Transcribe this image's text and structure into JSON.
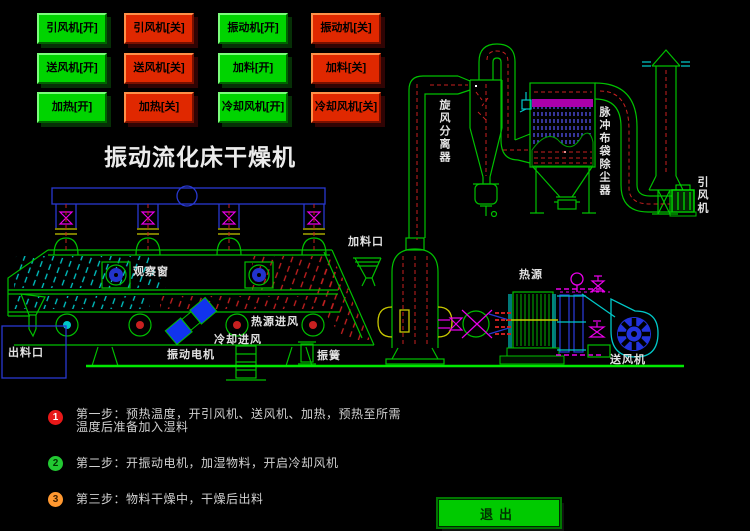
{
  "title": "振动流化床干燥机",
  "buttons": {
    "items": [
      {
        "label": "引风机[开]",
        "state": "on"
      },
      {
        "label": "引风机[关]",
        "state": "off"
      },
      {
        "label": "振动机[开]",
        "state": "on"
      },
      {
        "label": "振动机[关]",
        "state": "off"
      },
      {
        "label": "送风机[开]",
        "state": "on"
      },
      {
        "label": "送风机[关]",
        "state": "off"
      },
      {
        "label": "加料[开]",
        "state": "on"
      },
      {
        "label": "加料[关]",
        "state": "off"
      },
      {
        "label": "加热[开]",
        "state": "on"
      },
      {
        "label": "加热[关]",
        "state": "off"
      },
      {
        "label": "冷却风机[开]",
        "state": "on"
      },
      {
        "label": "冷却风机[关]",
        "state": "off"
      }
    ]
  },
  "diagram": {
    "labels": {
      "cyclone": "旋风分离器",
      "bag_filter": "脉冲布袋除尘器",
      "induced_fan": "引风机",
      "feed_inlet": "加料口",
      "observation_window": "观察窗",
      "heat_air_inlet": "热源进风",
      "cooling_air_inlet": "冷却进风",
      "discharge_outlet": "出料口",
      "vibration_motor": "振动电机",
      "vibration_spring": "振簧",
      "heat_source": "热源",
      "supply_fan": "送风机"
    }
  },
  "steps": {
    "items": [
      {
        "num": "1",
        "line1": "第一步：预热温度，开引风机、送风机、加热，预热至所需",
        "line2": "温度后准备加入湿料"
      },
      {
        "num": "2",
        "line1": "第二步：开振动电机，加湿物料，开启冷却风机",
        "line2": ""
      },
      {
        "num": "3",
        "line1": "第三步：物料干燥中，干燥后出料",
        "line2": ""
      }
    ]
  },
  "exit": {
    "label": "退出"
  },
  "colors": {
    "background": "#000000",
    "button_on": "#00D400",
    "button_off": "#E02800",
    "diagram_green": "#00C000",
    "bright_green": "#00E800",
    "cyan": "#00C8C8",
    "blue": "#2838D0",
    "magenta": "#E800E8",
    "red_dash": "#C82020",
    "yellow": "#C8C800",
    "label_text": "#E2E2E2",
    "step1_badge": "#E81818",
    "step2_badge": "#22C832",
    "step3_badge": "#FF9830"
  }
}
